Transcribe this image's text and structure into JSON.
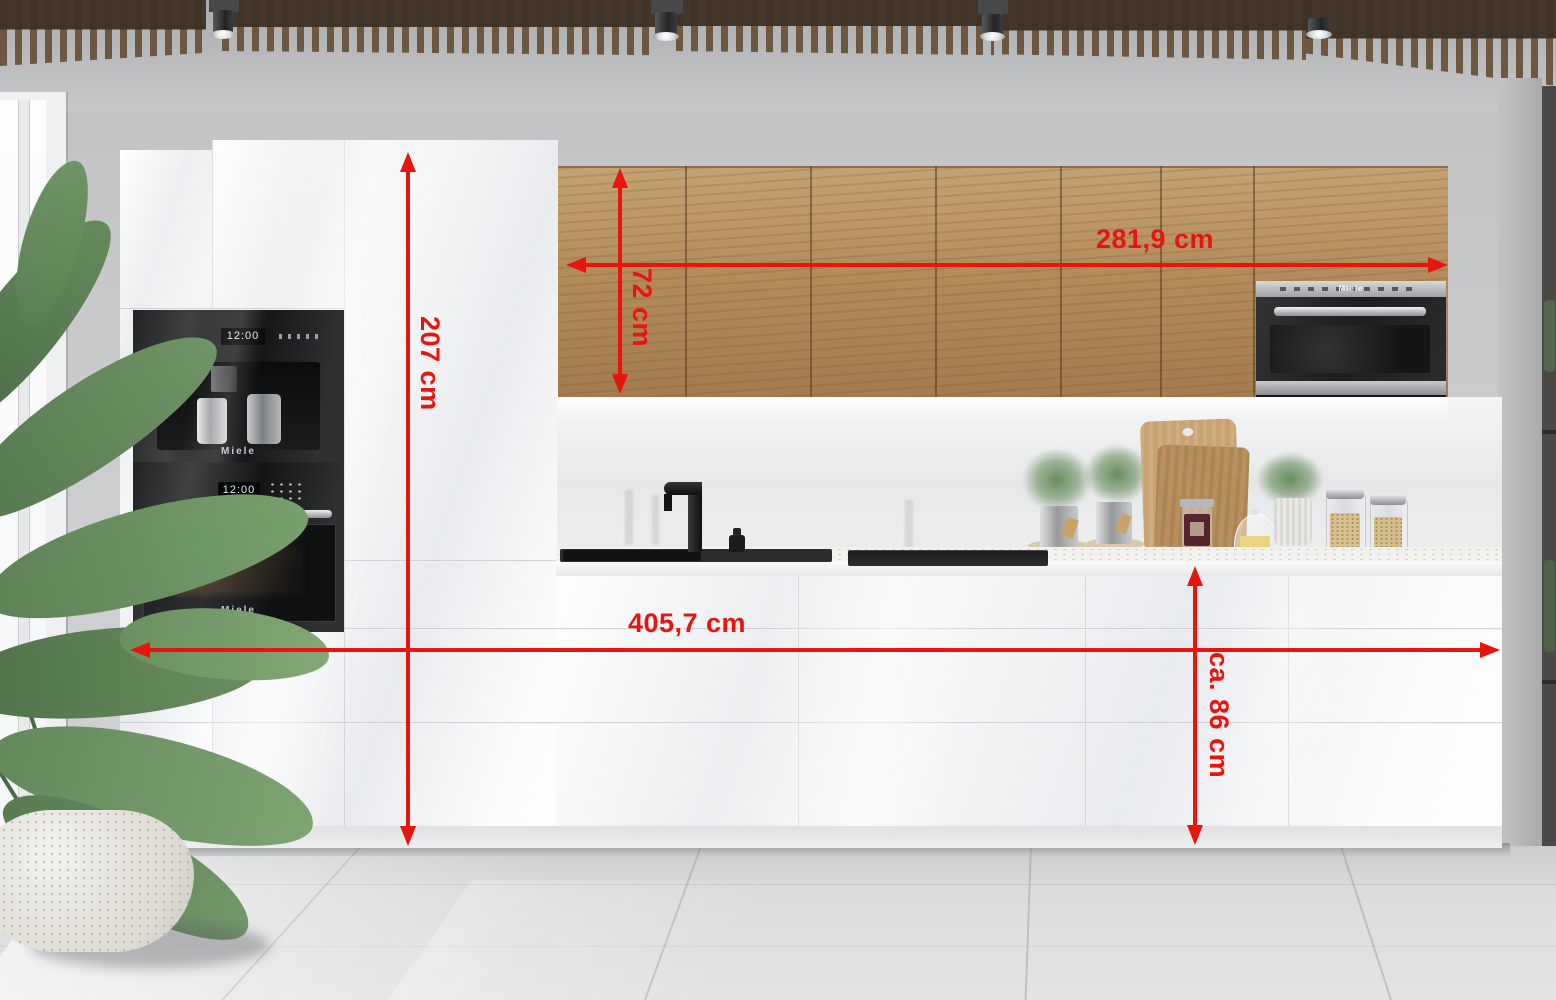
{
  "scene": {
    "title": "Modern white gloss kitchen with oak wall cabinets and measurement overlay"
  },
  "dimensions": {
    "upper_width": "281,9 cm",
    "upper_height": "72 cm",
    "tall_height": "207 cm",
    "total_width": "405,7 cm",
    "base_height": "ca. 86 cm"
  },
  "appliances": {
    "coffee_machine": {
      "brand": "Miele",
      "display": "12:00"
    },
    "oven": {
      "brand": "Miele",
      "display": "12:00"
    },
    "microwave": {
      "brand": "Miele"
    }
  },
  "colors": {
    "dimension_red": "#e8150f",
    "oak_wood": "#b48c5c",
    "cabinet_white": "#f2f3f5",
    "appliance_black": "#1d1f21",
    "wall_grey": "#c8c9cb",
    "ceiling_slat_brown": "#6e5740"
  }
}
